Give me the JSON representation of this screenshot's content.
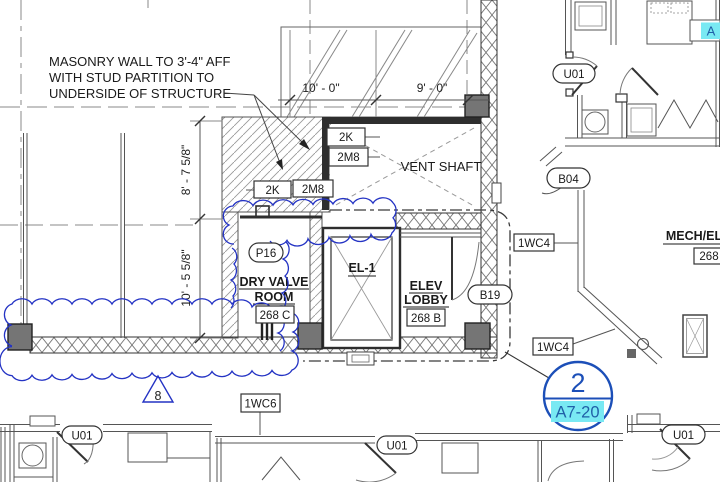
{
  "colors": {
    "revision_cloud": "#2433c4",
    "callout_blue": "#1c4fb8",
    "highlight_cyan": "#79e9f3",
    "highlight_text_blue": "#2060a8",
    "wall_dark": "#2e2e2e",
    "line_gray": "#8a8a8a",
    "column_fill": "#757575"
  },
  "note": {
    "line1": "MASONRY WALL TO 3'-4\" AFF",
    "line2": "WITH STUD PARTITION TO",
    "line3": "UNDERSIDE OF STRUCTURE"
  },
  "dimensions": {
    "top_left": "10' - 0\"",
    "top_right": "9' - 0\"",
    "left_upper": "8' - 7 5/8\"",
    "left_lower": "10' - 5 5/8\""
  },
  "wall_tags": {
    "k1": "2K",
    "m1": "2M8",
    "k2": "2K",
    "m2": "2M8",
    "wc4_upper": "1WC4",
    "wc4_lower": "1WC4",
    "wc6": "1WC6"
  },
  "door_tags": {
    "u01_top_right": "U01",
    "b04": "B04",
    "b19": "B19",
    "p16": "P16",
    "u01_bottom_left": "U01",
    "u01_bottom_middle": "U01",
    "u01_bottom_right": "U01"
  },
  "rooms": {
    "vent_shaft": "VENT SHAFT",
    "dry_valve_line1": "DRY VALVE",
    "dry_valve_line2": "ROOM",
    "dry_valve_number": "268 C",
    "elevator": "EL-1",
    "lobby_line1": "ELEV",
    "lobby_line2": "LOBBY",
    "lobby_number": "268 B",
    "mech": "MECH/EL",
    "mech_number": "268"
  },
  "revision": {
    "delta_number": "8"
  },
  "callout": {
    "detail_number": "2",
    "sheet_number": "A7-20"
  },
  "highlight_tag": {
    "label": "A"
  }
}
